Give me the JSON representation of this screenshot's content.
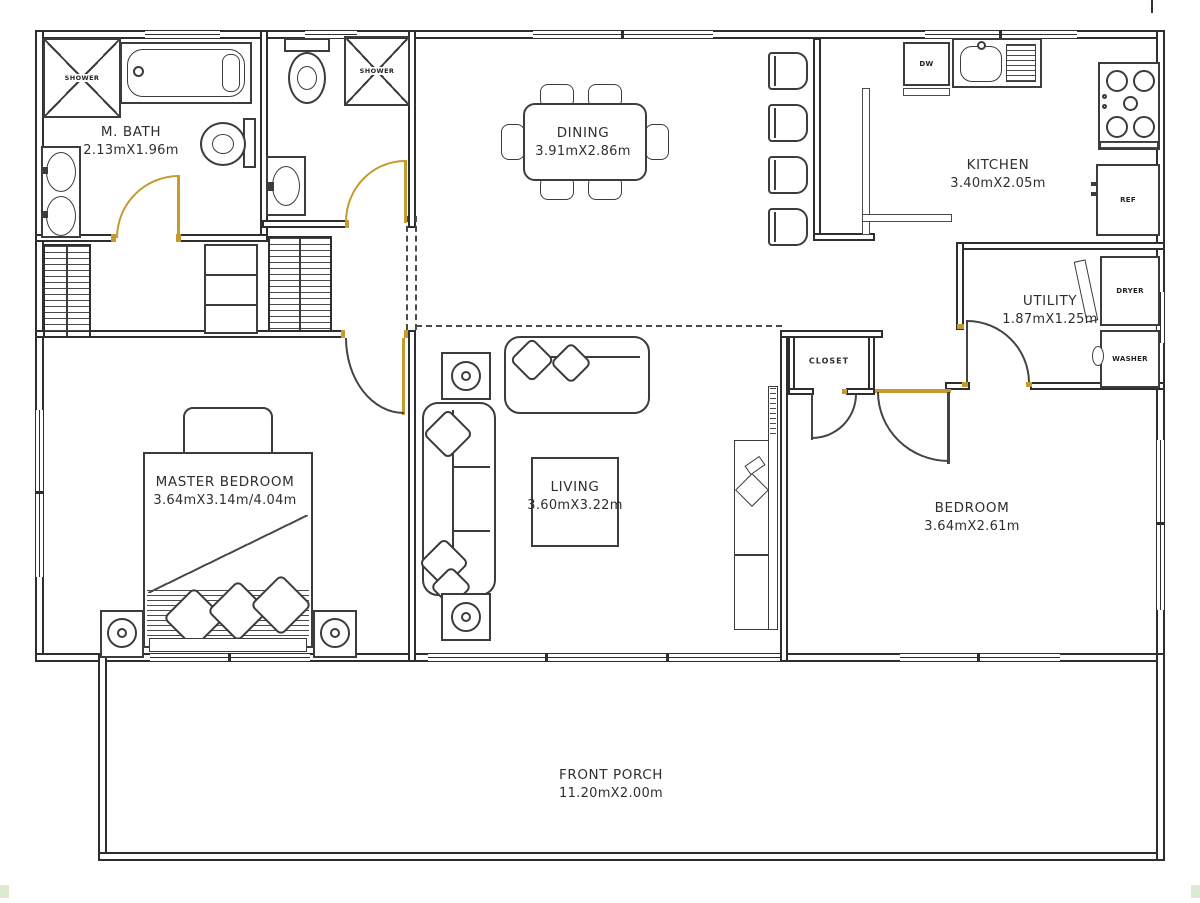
{
  "title": "House Floor Plan",
  "colors": {
    "wall": "#2e2e2e",
    "furniture": "#3c3c3c",
    "door_accent": "#c49a33",
    "label_text": "#2f2f2f",
    "corner_marker_green": "#dcead2"
  },
  "rooms": {
    "mbath": {
      "name": "M. BATH",
      "dims": "2.13mX1.96m"
    },
    "dining": {
      "name": "DINING",
      "dims": "3.91mX2.86m"
    },
    "kitchen": {
      "name": "KITCHEN",
      "dims": "3.40mX2.05m"
    },
    "utility": {
      "name": "UTILITY",
      "dims": "1.87mX1.25m"
    },
    "master": {
      "name": "MASTER BEDROOM",
      "dims": "3.64mX3.14m/4.04m"
    },
    "living": {
      "name": "LIVING",
      "dims": "3.60mX3.22m"
    },
    "closet": {
      "name": "CLOSET"
    },
    "bedroom": {
      "name": "BEDROOM",
      "dims": "3.64mX2.61m"
    },
    "porch": {
      "name": "FRONT PORCH",
      "dims": "11.20mX2.00m"
    }
  },
  "fixtures": {
    "shower_mbath": "SHOWER",
    "shower_bath2": "SHOWER",
    "dishwasher": "DW",
    "refrigerator": "REF",
    "dryer": "DRYER",
    "washer": "WASHER"
  }
}
